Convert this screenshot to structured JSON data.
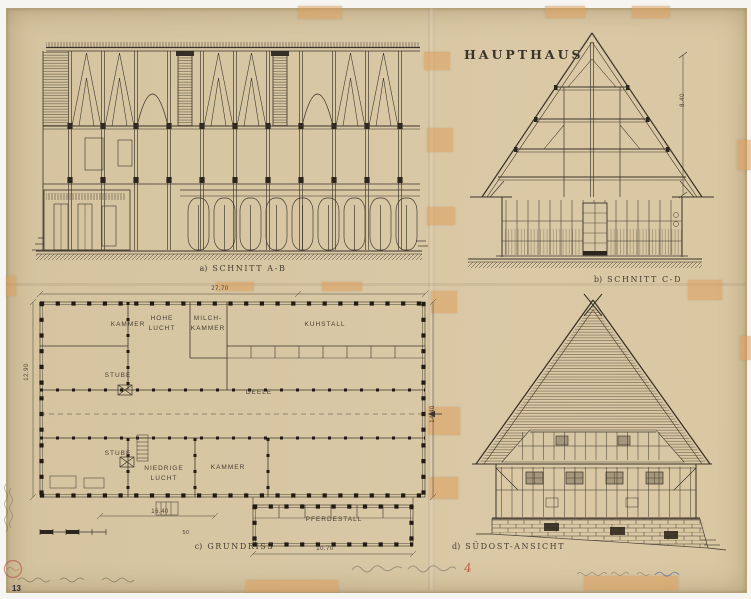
{
  "title": "HAUPTHAUS",
  "drawings": {
    "section_ab": {
      "prefix": "a)",
      "label": "SCHNITT A-B"
    },
    "section_cd": {
      "prefix": "b)",
      "label": "SCHNITT C-D",
      "height_dim": "8.40"
    },
    "plan": {
      "prefix": "c)",
      "label": "GRUNDRISS",
      "rooms": {
        "kammer1": "KAMMER",
        "hohe_lucht": "HOHE\nLUCHT",
        "milchkammer": "MILCH-\nKAMMER",
        "kuhstall": "KUHSTALL",
        "stube1": "STUBE",
        "deele": "DEELE",
        "stube2": "STUBE",
        "niedrige_lucht": "NIEDRIGE\nLUCHT",
        "kammer2": "KAMMER",
        "pferdestall": "PFERDESTALL"
      },
      "dimensions": {
        "top": "27.70",
        "left": "12.90",
        "right": "14.40",
        "bottom_left": "16.40",
        "scale_mark": "50",
        "bottom_right": "10.70"
      }
    },
    "elevation": {
      "prefix": "d)",
      "label": "SÜDOST-ANSICHT"
    }
  },
  "marginalia": {
    "page_number": "13",
    "red_mark": "4"
  }
}
